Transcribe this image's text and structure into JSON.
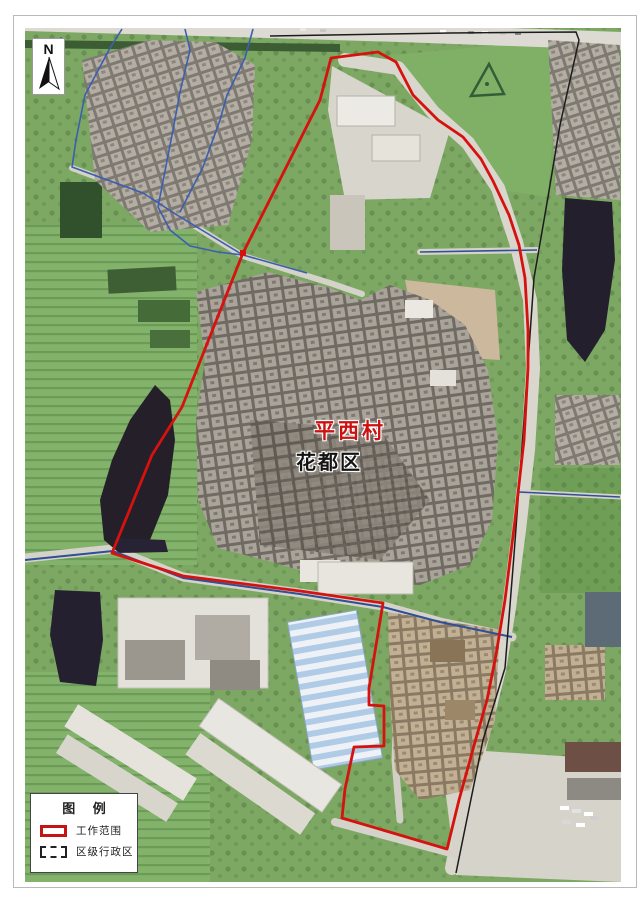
{
  "map": {
    "village_label": "平西村",
    "district_label": "花都区",
    "colors": {
      "work_scope_red": "#d6120f",
      "road_blue": "#3b5fb0",
      "railway_black": "#1c1c1c",
      "village_label_red": "#cc1111",
      "district_label_black": "#141414"
    }
  },
  "north_arrow": {
    "label": "N"
  },
  "legend": {
    "title": "图 例",
    "items": [
      {
        "label": "工作范围",
        "swatch_color": "#c41414",
        "swatch_style": "solid-red-rect"
      },
      {
        "label": "区级行政区",
        "swatch_color": "#222222",
        "swatch_style": "black-dashed-rect"
      }
    ]
  }
}
